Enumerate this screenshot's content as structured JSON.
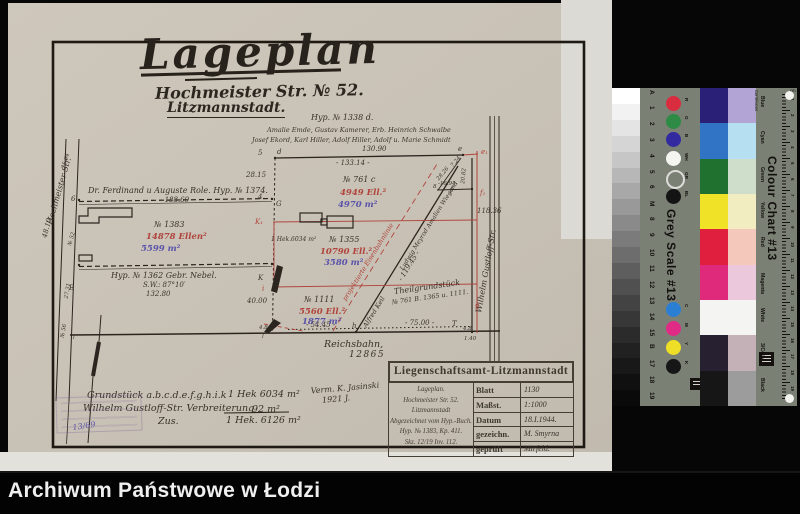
{
  "titles": {
    "main": "Lageplan",
    "street": "Hochmeister Str. № 52.",
    "city": "Litzmannstadt."
  },
  "plan": {
    "labels": [
      {
        "n": "hyp-1338-label",
        "t": "Hyp. № 1338 d.",
        "x": 311,
        "y": 113,
        "c": "hw-sm"
      },
      {
        "n": "owners-line-1",
        "t": "Amalie Emde, Gustav Kamerer, Erb. Heinrich Schwalbe",
        "x": 267,
        "y": 126,
        "c": "hw-xs"
      },
      {
        "n": "owners-line-2",
        "t": "Josef Ekord, Karl Hiller, Adolf Hiller, Adolf u. Marie Schmidt",
        "x": 252,
        "y": 136,
        "c": "hw-xs"
      },
      {
        "n": "measure-130-90",
        "t": "130.90",
        "x": 362,
        "y": 145,
        "c": "meas"
      },
      {
        "n": "measure-133-14",
        "t": "- 133.14 -",
        "x": 336,
        "y": 159,
        "c": "meas"
      },
      {
        "n": "point-5",
        "t": "5",
        "x": 258,
        "y": 149,
        "c": "meas"
      },
      {
        "n": "point-d",
        "t": "d",
        "x": 277,
        "y": 148,
        "c": "meas"
      },
      {
        "n": "point-e",
        "t": "e",
        "x": 458,
        "y": 145,
        "c": "meas"
      },
      {
        "n": "point-e1",
        "t": "e₁",
        "x": 481,
        "y": 148,
        "c": "meas red"
      },
      {
        "n": "measure-28-15",
        "t": "28.15",
        "x": 246,
        "y": 171,
        "c": "meas"
      },
      {
        "n": "role-owner-label",
        "t": "Dr. Ferdinand u Auguste Role.  Hyp. № 1374.",
        "x": 88,
        "y": 186,
        "c": "hw-sm"
      },
      {
        "n": "measure-188-60",
        "t": "- 188.60 -",
        "x": 160,
        "y": 196,
        "c": "meas"
      },
      {
        "n": "point-6",
        "t": "6",
        "x": 71,
        "y": 195,
        "c": "meas"
      },
      {
        "n": "point-4",
        "t": "4",
        "x": 258,
        "y": 193,
        "c": "meas"
      },
      {
        "n": "point-G",
        "t": "G",
        "x": 276,
        "y": 200,
        "c": "meas"
      },
      {
        "n": "parcel-761c-number",
        "t": "№ 761 c",
        "x": 343,
        "y": 175,
        "c": "hw-sm"
      },
      {
        "n": "parcel-761c-ellen",
        "t": "4949 Ell.²",
        "x": 340,
        "y": 188,
        "c": "val red"
      },
      {
        "n": "parcel-761c-m2",
        "t": "4970 m²",
        "x": 338,
        "y": 200,
        "c": "val blue"
      },
      {
        "n": "parcel-1383-number",
        "t": "№ 1383",
        "x": 154,
        "y": 220,
        "c": "hw-sm"
      },
      {
        "n": "parcel-1383-ellen",
        "t": "14878 Ellen²",
        "x": 146,
        "y": 232,
        "c": "val red"
      },
      {
        "n": "parcel-1383-m2",
        "t": "5599 m²",
        "x": 141,
        "y": 244,
        "c": "val blue"
      },
      {
        "n": "point-K1",
        "t": "K₁",
        "x": 255,
        "y": 218,
        "c": "meas red"
      },
      {
        "n": "hek-6034-note",
        "t": "1 Hek.6034 m²",
        "x": 271,
        "y": 236,
        "c": "hw-xxs"
      },
      {
        "n": "parcel-1355-number",
        "t": "№ 1355",
        "x": 329,
        "y": 235,
        "c": "hw-sm"
      },
      {
        "n": "parcel-1355-ellen",
        "t": "10790 Ell.²",
        "x": 320,
        "y": 247,
        "c": "val red"
      },
      {
        "n": "parcel-1355-m2",
        "t": "3580 m²",
        "x": 324,
        "y": 258,
        "c": "val blue"
      },
      {
        "n": "projected-railway-label",
        "t": "projektierte  Eisenbahnlinie",
        "x": 368,
        "y": 262,
        "c": "hw-xs red",
        "r": -58
      },
      {
        "n": "diagonal-name-1",
        "t": "Alfred Keil",
        "x": 374,
        "y": 312,
        "c": "hw-xs",
        "r": -58
      },
      {
        "n": "measure-119-45",
        "t": "- 119.45 -",
        "x": 409,
        "y": 266,
        "c": "meas",
        "r": -58
      },
      {
        "n": "diagonal-name-2",
        "t": "Ludwig Meyrod  Amalien Wiegand",
        "x": 429,
        "y": 226,
        "c": "hw-xxs",
        "r": -58
      },
      {
        "n": "theilgrundstueck-line-1",
        "t": "Theilgrundstück",
        "x": 427,
        "y": 287,
        "c": "hw-sm",
        "r": -8
      },
      {
        "n": "theilgrundstueck-line-2",
        "t": "№ 761 B. 1365 u. 1111.",
        "x": 430,
        "y": 297,
        "c": "hw-xs",
        "r": -8
      },
      {
        "n": "nebel-owner-label",
        "t": "Hyp. № 1362    Gebr. Nebel.",
        "x": 111,
        "y": 271,
        "c": "hw-sm"
      },
      {
        "n": "measure-sw-angle",
        "t": "S.W.: 87°10′",
        "x": 143,
        "y": 281,
        "c": "meas"
      },
      {
        "n": "measure-132-80",
        "t": "132.80",
        "x": 146,
        "y": 290,
        "c": "meas"
      },
      {
        "n": "point-B",
        "t": "B",
        "x": 69,
        "y": 284,
        "c": "meas"
      },
      {
        "n": "point-K",
        "t": "K",
        "x": 258,
        "y": 274,
        "c": "meas"
      },
      {
        "n": "point-i",
        "t": "i",
        "x": 262,
        "y": 285,
        "c": "meas red"
      },
      {
        "n": "measure-40-00",
        "t": "40.00",
        "x": 247,
        "y": 297,
        "c": "meas"
      },
      {
        "n": "parcel-1111-number",
        "t": "№ 1111",
        "x": 304,
        "y": 295,
        "c": "hw-sm"
      },
      {
        "n": "parcel-1111-ellen",
        "t": "5560 Ell.²",
        "x": 299,
        "y": 307,
        "c": "val red"
      },
      {
        "n": "parcel-1111-m2",
        "t": "1877 m²",
        "x": 302,
        "y": 317,
        "c": "val blue"
      },
      {
        "n": "measure-54-45",
        "t": "- 54.45 -",
        "x": 306,
        "y": 321,
        "c": "meas"
      },
      {
        "n": "measure-75-00",
        "t": "- 75.00 -",
        "x": 405,
        "y": 319,
        "c": "meas"
      },
      {
        "n": "reichsbahn-label",
        "t": "Reichsbahn,",
        "x": 324,
        "y": 339,
        "c": "hw"
      },
      {
        "n": "measure-12865",
        "t": "12865",
        "x": 349,
        "y": 350,
        "c": "meas-lg"
      },
      {
        "n": "measure-118-36",
        "t": "118.36",
        "x": 477,
        "y": 207,
        "c": "meas"
      },
      {
        "n": "street-wilhelm-gustloff",
        "t": "Wilhelm Gustloff-Str.",
        "x": 486,
        "y": 271,
        "c": "hw-sm",
        "r": -80
      },
      {
        "n": "street-hochmeister",
        "t": "Hochmeister-Str.",
        "x": 59,
        "y": 191,
        "c": "hw-sm",
        "r": -74
      },
      {
        "n": "measure-16-94",
        "t": "-16.94-",
        "x": 438,
        "y": 181,
        "c": "meas-xs"
      },
      {
        "n": "measure-7-24",
        "t": "7.24",
        "x": 456,
        "y": 162,
        "c": "meas-xs",
        "r": -50
      },
      {
        "n": "measure-20-82",
        "t": "20.82",
        "x": 464,
        "y": 176,
        "c": "meas-xs",
        "r": -85
      },
      {
        "n": "measure-28-26",
        "t": "28.26",
        "x": 443,
        "y": 174,
        "c": "meas-xs",
        "r": -50
      },
      {
        "n": "point-f",
        "t": "f",
        "x": 450,
        "y": 186,
        "c": "meas"
      },
      {
        "n": "point-f1",
        "t": "f₁",
        "x": 480,
        "y": 189,
        "c": "meas red"
      },
      {
        "n": "point-g",
        "t": "g",
        "x": 475,
        "y": 301,
        "c": "meas red"
      },
      {
        "n": "point-h",
        "t": "h",
        "x": 352,
        "y": 322,
        "c": "meas"
      },
      {
        "n": "point-T",
        "t": "T",
        "x": 452,
        "y": 320,
        "c": "meas"
      },
      {
        "n": "point-8",
        "t": "8",
        "x": 433,
        "y": 184,
        "c": "meas-xs"
      },
      {
        "n": "measure-4-8-left",
        "t": "4.8",
        "x": 259,
        "y": 325,
        "c": "meas-xs"
      },
      {
        "n": "point-l-left",
        "t": "l",
        "x": 262,
        "y": 334,
        "c": "meas-xs"
      },
      {
        "n": "point-l-street",
        "t": "l",
        "x": 73,
        "y": 335,
        "c": "meas-xs"
      },
      {
        "n": "measure-4-8-right",
        "t": "4.8",
        "x": 463,
        "y": 326,
        "c": "meas-xs"
      },
      {
        "n": "measure-1-40",
        "t": "1.40",
        "x": 464,
        "y": 336,
        "c": "meas-xs"
      },
      {
        "n": "measure-48-10",
        "t": "48.10",
        "x": 47,
        "y": 228,
        "c": "meas",
        "r": -76
      },
      {
        "n": "measure-25-04",
        "t": "25.04",
        "x": 66,
        "y": 161,
        "c": "meas-xs",
        "r": -74
      },
      {
        "n": "measure-27-31",
        "t": "27.31",
        "x": 68,
        "y": 291,
        "c": "meas-xs",
        "r": -80
      },
      {
        "n": "house-no-52",
        "t": "№ 52",
        "x": 72,
        "y": 239,
        "c": "meas-xs",
        "r": -74
      },
      {
        "n": "house-no-56",
        "t": "№ 56",
        "x": 64,
        "y": 331,
        "c": "meas-xs",
        "r": -80
      },
      {
        "n": "summary-line-1-text",
        "t": "Grundstück a.b.c.d.e.f.g.h.i.k",
        "x": 87,
        "y": 390,
        "c": "hw"
      },
      {
        "n": "summary-line-1-value",
        "t": "1 Hek 6034 m²",
        "x": 228,
        "y": 389,
        "c": "hw"
      },
      {
        "n": "summary-line-2-text",
        "t": "Wilhelm Gustloff-Str. Verbreiterung",
        "x": 83,
        "y": 403,
        "c": "hw"
      },
      {
        "n": "summary-line-2-value",
        "t": "92 m²",
        "x": 252,
        "y": 404,
        "c": "hw"
      },
      {
        "n": "summary-zus-label",
        "t": "Zus.",
        "x": 158,
        "y": 416,
        "c": "hw"
      },
      {
        "n": "summary-total-value",
        "t": "1 Hek. 6126 m²",
        "x": 226,
        "y": 415,
        "c": "hw"
      },
      {
        "n": "surveyor-line-1",
        "t": "Verm. K. Jasinski",
        "x": 345,
        "y": 388,
        "c": "hw-sm",
        "r": -5
      },
      {
        "n": "surveyor-line-2",
        "t": "1921 J.",
        "x": 336,
        "y": 399,
        "c": "hw-sm",
        "r": -5
      },
      {
        "n": "stamp-number",
        "t": "13/69",
        "x": 84,
        "y": 426,
        "c": "hw-sm blue",
        "r": -8
      }
    ]
  },
  "table": {
    "header": "Liegenschaftsamt-Litzmannstadt",
    "left_lines": [
      "Lageplan.",
      "Hochmeister Str. 52.",
      "Litzmannstadt",
      "Abgezeichnet vom Hyp.-Buch.",
      "Hyp. № 1383, Kp. 411.",
      "Skz. 12/19 Inv. 112."
    ],
    "rows": [
      {
        "label": "Blatt",
        "value": "1130"
      },
      {
        "label": "Maßst.",
        "value": "1:1000"
      },
      {
        "label": "Datum",
        "value": "18.I.1944."
      },
      {
        "label": "gezeichn.",
        "value": "M. Smyrna"
      },
      {
        "label": "geprüft",
        "value": "Mirfeld."
      }
    ]
  },
  "chart": {
    "grey_scale_title": "Grey Scale #13",
    "colour_chart_title": "Colour Chart #13",
    "continuous": "Continuous",
    "cm": "cm",
    "grey_steps": [
      "#ffffff",
      "#f2f2f2",
      "#e4e4e4",
      "#d5d5d5",
      "#c6c6c6",
      "#b7b7b7",
      "#a8a8a8",
      "#999999",
      "#8a8a8a",
      "#7b7b7b",
      "#6d6d6d",
      "#5e5e5e",
      "#505050",
      "#434343",
      "#373737",
      "#2b2b2b",
      "#212121",
      "#181818",
      "#101010",
      "#0a0a0a"
    ],
    "step_labels": [
      "A",
      "1",
      "2",
      "3",
      "4",
      "5",
      "6",
      "M",
      "8",
      "9",
      "10",
      "11",
      "12",
      "13",
      "14",
      "15",
      "B",
      "17",
      "18",
      "19"
    ],
    "top_circles": [
      {
        "l": "R",
        "c": "#d92c3e"
      },
      {
        "l": "G",
        "c": "#2e8b45"
      },
      {
        "l": "B",
        "c": "#322a9e"
      },
      {
        "l": "WH",
        "c": "#f4f4f1"
      },
      {
        "l": "GR",
        "c": "ring"
      },
      {
        "l": "BL",
        "c": "#141414"
      }
    ],
    "bottom_circles": [
      {
        "l": "C",
        "c": "#2a7fd4"
      },
      {
        "l": "M",
        "c": "#df2a86"
      },
      {
        "l": "Y",
        "c": "#eede26"
      },
      {
        "l": "K",
        "c": "#161616"
      }
    ],
    "rows": [
      {
        "label": "Blue",
        "solid": "#2b2077",
        "light": "#b2a4d4"
      },
      {
        "label": "Cyan",
        "solid": "#3173c5",
        "light": "#b7dff2"
      },
      {
        "label": "Green",
        "solid": "#20712f",
        "light": "#cfdeca"
      },
      {
        "label": "Yellow",
        "solid": "#f0e227",
        "light": "#f1edc0"
      },
      {
        "label": "Red",
        "solid": "#df1f3d",
        "light": "#f4c9bc"
      },
      {
        "label": "Magenta",
        "solid": "#df2a7c",
        "light": "#ecc8dd"
      },
      {
        "label": "White",
        "solid": "#f4f4f2",
        "light": "#f4f4f2"
      },
      {
        "label": "3/Color",
        "solid": "#262031",
        "light": "#c3b1b7"
      },
      {
        "label": "Black",
        "solid": "#161616",
        "light": "#9c9c9c"
      }
    ],
    "ruler_numbers": [
      "1",
      "2",
      "3",
      "4",
      "5",
      "6",
      "7",
      "8",
      "9",
      "10",
      "11",
      "12",
      "13",
      "14",
      "15",
      "16",
      "17",
      "18",
      "19"
    ]
  },
  "footer": {
    "text": "Archiwum Państwowe w Łodzi"
  }
}
